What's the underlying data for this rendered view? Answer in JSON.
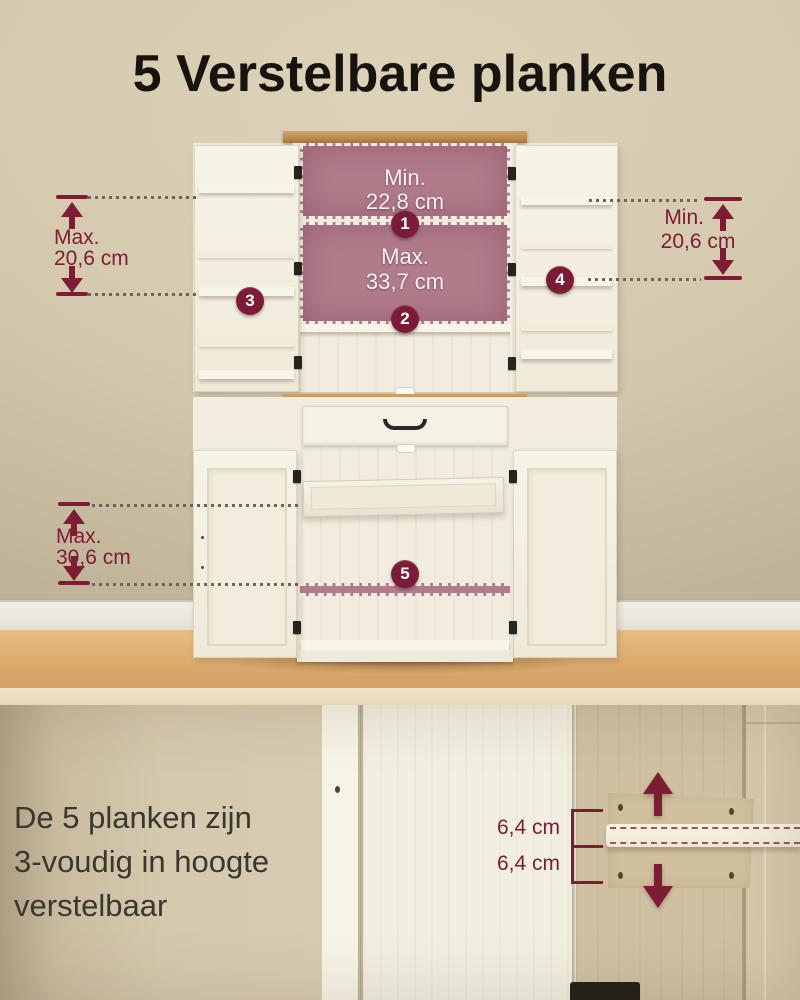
{
  "title": "5 Verstelbare planken",
  "annotations": {
    "shelf_top": {
      "badge": "1",
      "label_line1": "Min.",
      "label_line2": "22,8 cm"
    },
    "shelf_middle": {
      "badge": "2",
      "label_line1": "Max.",
      "label_line2": "33,7 cm"
    },
    "door_left": {
      "badge": "3",
      "label_line1": "Max.",
      "label_line2": "20,6 cm"
    },
    "door_right": {
      "badge": "4",
      "label_line1": "Min.",
      "label_line2": "20,6 cm"
    },
    "shelf_bottom": {
      "badge": "5",
      "label_line1": "Max.",
      "label_line2": "30,6 cm"
    }
  },
  "detail": {
    "caption_line1": "De 5 planken zijn",
    "caption_line2": "3-voudig in hoogte",
    "caption_line3": "verstelbaar",
    "gap_label_top": "6,4 cm",
    "gap_label_bottom": "6,4 cm"
  },
  "icons": {
    "up_arrow": "▲",
    "down_arrow": "▼"
  },
  "colors": {
    "accent_maroon": "#7d1c35",
    "highlight_pink": "#b17b8a",
    "badge_background": "#7c1b38",
    "wall_beige": "#d4c8ad",
    "floor_wood": "#dcab6e",
    "cabinet_white": "#f3efe2",
    "counter_wood": "#bd8e50",
    "title_text": "#17140f",
    "caption_text": "#3a3731"
  }
}
